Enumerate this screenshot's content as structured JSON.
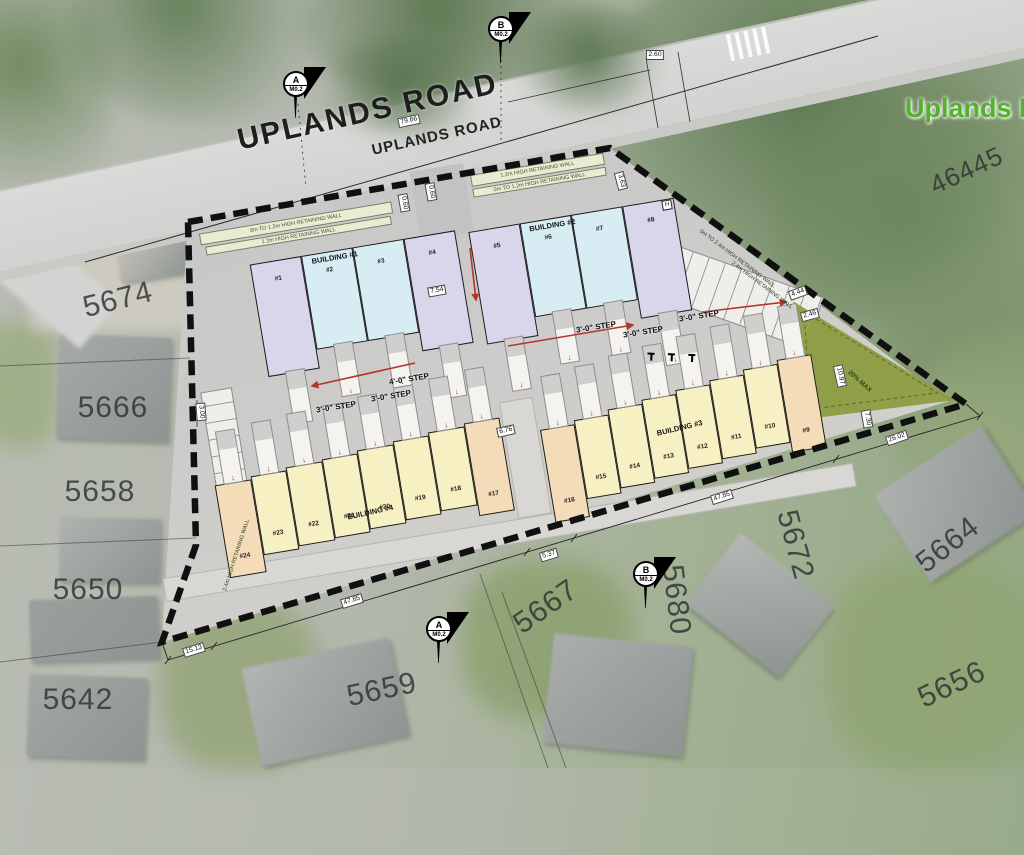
{
  "road": {
    "name_large": "UPLANDS ROAD",
    "name_small": "UPLANDS ROAD"
  },
  "map_labels": {
    "park": "Uplands P",
    "parcel": "46445"
  },
  "lots": [
    "5674",
    "5666",
    "5658",
    "5650",
    "5642",
    "5659",
    "5667",
    "5680",
    "5672",
    "5664",
    "5656"
  ],
  "markers": [
    {
      "letter": "A",
      "sheet": "M0.2"
    },
    {
      "letter": "B",
      "sheet": "M0.2"
    },
    {
      "letter": "A",
      "sheet": "M0.2"
    },
    {
      "letter": "B",
      "sheet": "M0.2"
    }
  ],
  "buildings": [
    {
      "name": "BUILDING #1",
      "units": [
        {
          "num": "#1",
          "color": "lavender"
        },
        {
          "num": "#2",
          "color": "blue"
        },
        {
          "num": "#3",
          "color": "blue"
        },
        {
          "num": "#4",
          "color": "lavender"
        }
      ]
    },
    {
      "name": "BUILDING #2",
      "units": [
        {
          "num": "#5",
          "color": "lavender"
        },
        {
          "num": "#6",
          "color": "blue"
        },
        {
          "num": "#7",
          "color": "blue"
        },
        {
          "num": "#8",
          "color": "lavender"
        }
      ]
    },
    {
      "name": "BUILDING #3",
      "units": [
        {
          "num": "#16",
          "color": "peach"
        },
        {
          "num": "#15",
          "color": "yellow"
        },
        {
          "num": "#14",
          "color": "yellow"
        },
        {
          "num": "#13",
          "color": "yellow"
        },
        {
          "num": "#12",
          "color": "yellow"
        },
        {
          "num": "#11",
          "color": "yellow"
        },
        {
          "num": "#10",
          "color": "yellow"
        },
        {
          "num": "#9",
          "color": "peach"
        }
      ]
    },
    {
      "name": "BUILDING #4",
      "units": [
        {
          "num": "#24",
          "color": "peach"
        },
        {
          "num": "#23",
          "color": "yellow"
        },
        {
          "num": "#22",
          "color": "yellow"
        },
        {
          "num": "#21",
          "color": "yellow"
        },
        {
          "num": "#20",
          "color": "yellow"
        },
        {
          "num": "#19",
          "color": "yellow"
        },
        {
          "num": "#18",
          "color": "yellow"
        },
        {
          "num": "#17",
          "color": "peach"
        }
      ]
    }
  ],
  "dimensions": [
    "79.66",
    "2.60",
    "7.54",
    "6.76",
    "3.00",
    "15.13",
    "47.85",
    "5.37",
    "47.85",
    "26.02",
    "2.46",
    "10.97",
    "7.30",
    "4.44",
    "0.60",
    "0.60",
    "3.63"
  ],
  "steps": [
    "4'-0\" STEP",
    "3'-0\" STEP",
    "3'-0\" STEP",
    "3'-0\" STEP",
    "3'-0\" STEP",
    "3'-0\" STEP"
  ],
  "retaining_walls": [
    "0m TO 1.2m HIGH RETAINING WALL",
    "1.2m HIGH RETAINING WALL",
    "0m TO 2.4m HIGH RETAINING WALL",
    "2.4m HIGH RETAINING WALL",
    "2.4m HIGH RETAINING WALL"
  ],
  "misc": {
    "slope": "20% MAX",
    "hydrant": "H"
  },
  "colors": {
    "lavender": "#d9d5eb",
    "blue": "#d8edf3",
    "yellow": "#f6f0c2",
    "peach": "#f4dcb8",
    "site_green": "#8a9b3d",
    "boundary": "#101010",
    "paving": "#c8c8ca",
    "park_text": "#54b02e",
    "slope_arrow_red": "#b5342c"
  }
}
